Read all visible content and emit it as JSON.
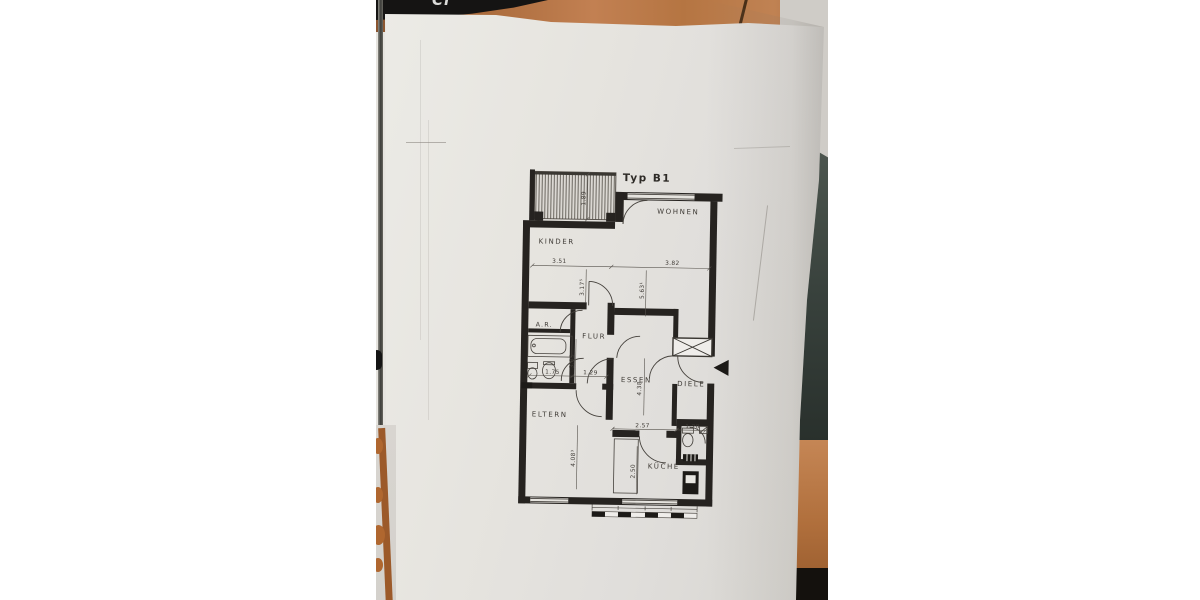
{
  "scene": {
    "desk_object_text": "Ci",
    "colors": {
      "desk_wood": "#b06f3e",
      "paper": "#e6e4df",
      "plan_ink": "#262320",
      "dark_object": "#39423d"
    }
  },
  "plan": {
    "title": "Typ B1",
    "rooms": {
      "wohnen": "WOHNEN",
      "kinder": "KINDER",
      "ar": "A.R.",
      "flur": "FLUR",
      "essen": "ESSEN",
      "diele": "DIELE",
      "eltern": "ELTERN",
      "kueche": "KÜCHE"
    },
    "dims": {
      "kinder_width": "3.51",
      "wohnen_width": "3.82",
      "kinder_depth": "3.17⁵",
      "wohnen_depth": "5.63¹",
      "balcony_depth": "1.89",
      "bath_width": "1.75",
      "flur_width": "1.29",
      "bath_depth": "3.85",
      "essen_depth": "4.38",
      "kueche_width": "2.57",
      "wc_width": "1.20",
      "eltern_depth": "4.08³",
      "kueche_depth": "2.50"
    }
  }
}
